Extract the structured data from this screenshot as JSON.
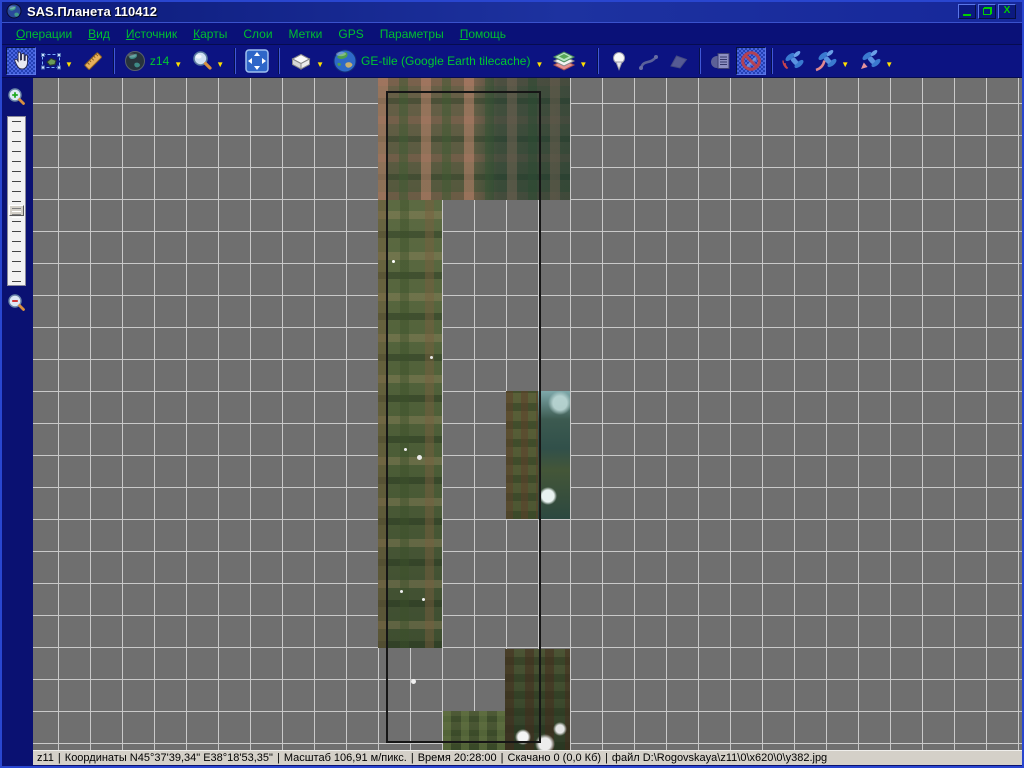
{
  "window": {
    "title": "SAS.Планета 110412",
    "controls": {
      "close_glyph": "X"
    }
  },
  "menu": {
    "items": [
      {
        "name": "operations",
        "u": "О",
        "rest": "перации"
      },
      {
        "name": "view",
        "u": "В",
        "rest": "ид"
      },
      {
        "name": "source",
        "u": "И",
        "rest": "сточник"
      },
      {
        "name": "maps",
        "u": "К",
        "rest": "арты"
      },
      {
        "name": "layers",
        "u": "",
        "rest": "Слои"
      },
      {
        "name": "marks",
        "u": "",
        "rest": "Метки"
      },
      {
        "name": "gps",
        "u": "",
        "rest": "GPS"
      },
      {
        "name": "options",
        "u": "",
        "rest": "Параметры"
      },
      {
        "name": "help",
        "u": "П",
        "rest": "омощь"
      }
    ]
  },
  "toolbar": {
    "zoom_label": "z14",
    "source_label": "GE-tile (Google Earth tilecache)",
    "dropdown_glyph": "▼",
    "icons": [
      "hand-tool-icon",
      "selection-tool-icon",
      "ruler-icon",
      "globe-zoom-icon",
      "magnifier-icon",
      "fullscreen-icon",
      "cache-box-icon",
      "earth-source-icon",
      "layers-stack-icon",
      "placemark-icon",
      "route-icon",
      "polygon-icon",
      "download-list-icon",
      "stop-download-icon",
      "gps-connect-icon",
      "gps-track-icon",
      "gps-position-icon"
    ]
  },
  "statusbar": {
    "separator": "|",
    "zoom": "z11",
    "coordinates": "Координаты N45°37'39,34\" E38°18'53,35\"",
    "scale": "Масштаб 106,91 м/пикс.",
    "time": "Время 20:28:00",
    "downloaded": "Скачано 0 (0,0 Кб)",
    "file": "файл D:\\Rogovskaya\\z11\\0\\x620\\0\\y382.jpg"
  },
  "colors": {
    "window_bg": "#0a1172",
    "titlebar": "#1d32a0",
    "menu_text": "#00c030",
    "toolbar_label": "#00c830",
    "dropdown_arrow": "#ffe000",
    "map_bg": "#6f6f6f",
    "map_grid": "#c9c9c9",
    "selection_border": "#161616",
    "statusbar_bg": "#d4d0c8",
    "window_button_glyph": "#00d000"
  }
}
